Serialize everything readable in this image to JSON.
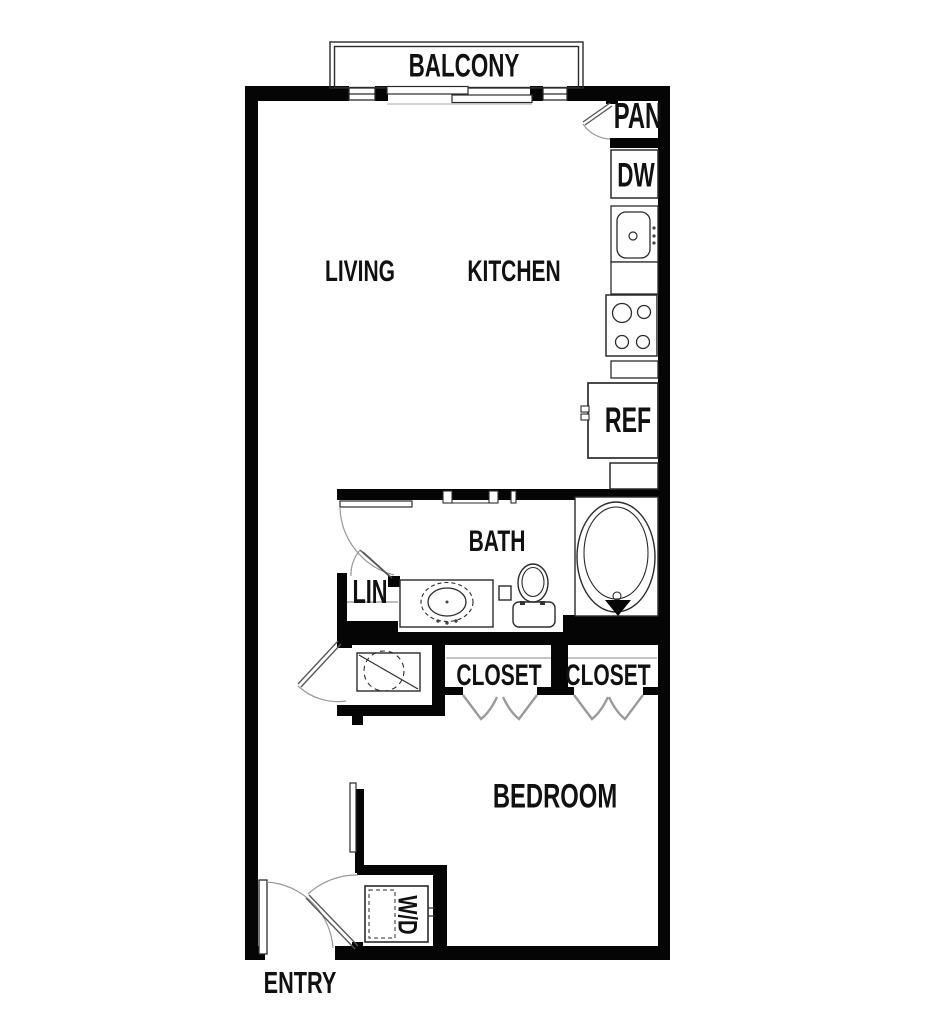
{
  "floor_plan": {
    "rooms": {
      "balcony": {
        "label": "BALCONY"
      },
      "living": {
        "label": "LIVING"
      },
      "kitchen": {
        "label": "KITCHEN"
      },
      "pantry": {
        "label": "PAN"
      },
      "bath": {
        "label": "BATH"
      },
      "linen": {
        "label": "LIN"
      },
      "closet_left": {
        "label": "CLOSET"
      },
      "closet_right": {
        "label": "CLOSET"
      },
      "bedroom": {
        "label": "BEDROOM"
      },
      "entry": {
        "label": "ENTRY"
      }
    },
    "appliances": {
      "dishwasher": {
        "label": "DW"
      },
      "refrigerator": {
        "label": "REF"
      },
      "washer_dryer": {
        "label": "W/D"
      }
    },
    "fixtures": [
      "bathtub",
      "toilet",
      "vanity-sink",
      "kitchen-sink",
      "range-burners",
      "water-heater",
      "bifold-closet-doors",
      "swing-doors",
      "balcony-sliding-door",
      "windows"
    ],
    "colors": {
      "wall": "#050505",
      "background": "#ffffff",
      "line": "#2b2b2b",
      "door_arc": "#999999",
      "bifold_door": "#9b9b9b",
      "text": "#111111"
    }
  }
}
